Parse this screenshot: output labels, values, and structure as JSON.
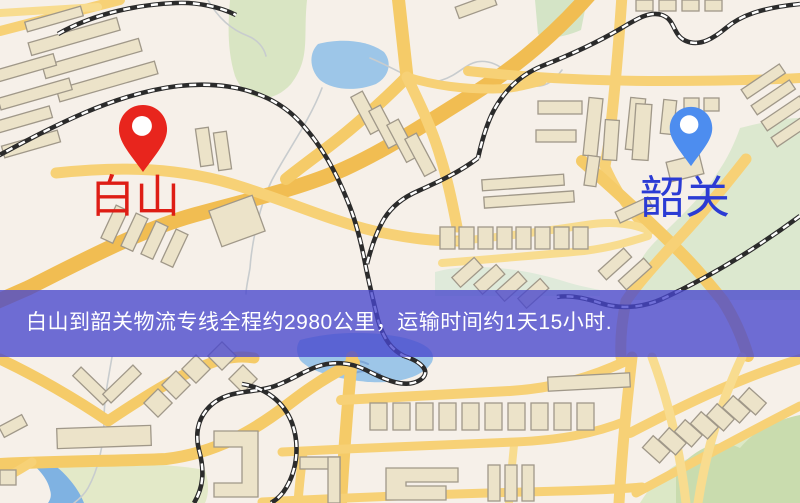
{
  "map": {
    "origin_label": "白山",
    "destination_label": "韶关",
    "banner": {
      "text": "白山到韶关物流专线全程约2980公里，运输时间约1天15小时."
    },
    "colors": {
      "origin_pin": "#e8251d",
      "origin_text": "#de1d15",
      "dest_pin": "#4d8def",
      "dest_text": "#2b3bd4",
      "banner_bg": "rgba(72,70,205,0.78)",
      "banner_text": "#ffffff",
      "road_major": "#f1bd52",
      "road_minor": "#f7d176",
      "water": "#9dc6e8",
      "greenery": "#d9e5c3",
      "building": "#ece3c9",
      "railway": "#2b2b2b",
      "map_bg": "#f6f0e9"
    }
  }
}
